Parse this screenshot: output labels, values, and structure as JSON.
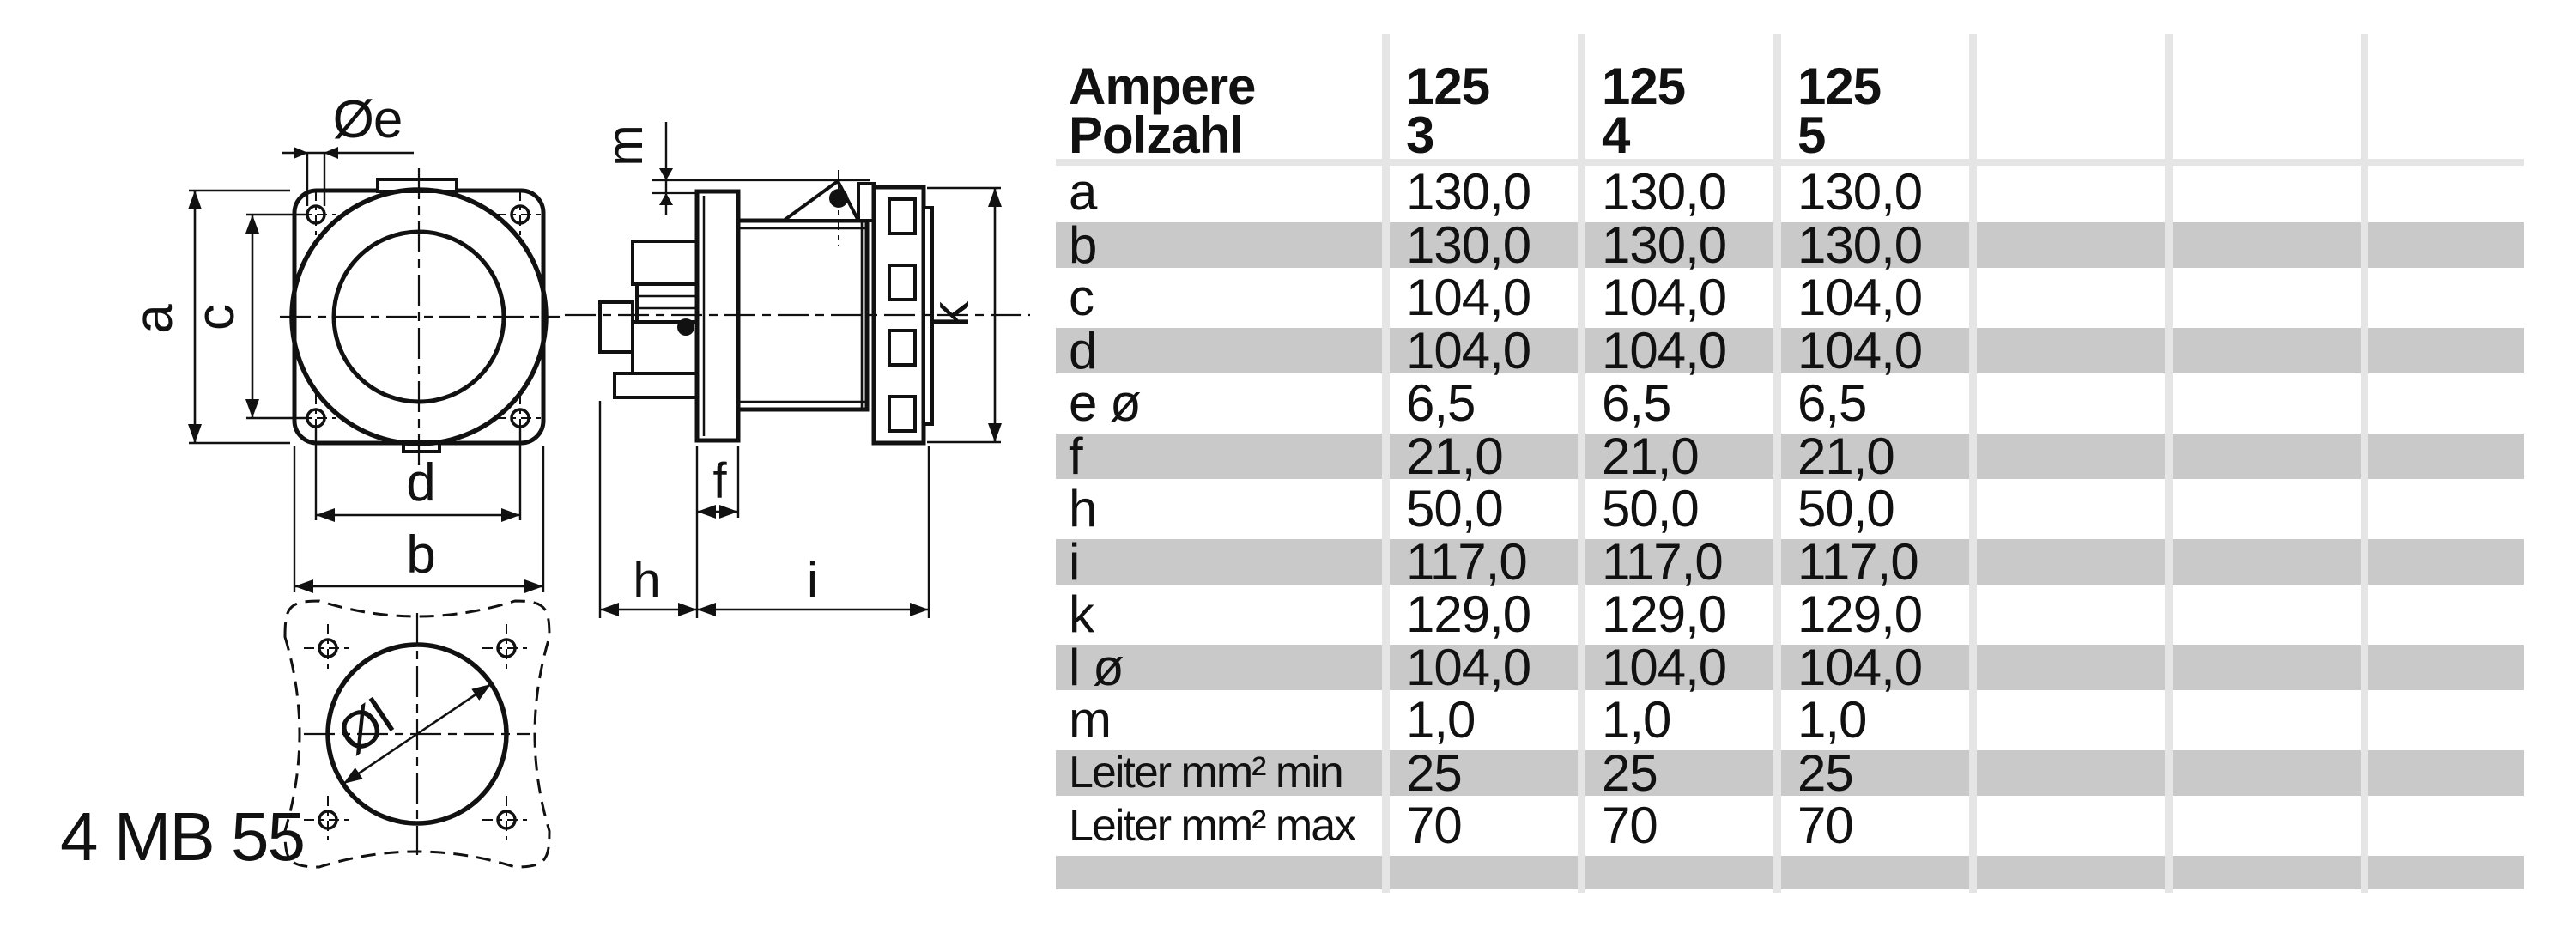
{
  "part_number": "4 MB 55",
  "drawing": {
    "labels": {
      "a": "a",
      "b": "b",
      "c": "c",
      "d": "d",
      "e_dia": "Øe",
      "f": "f",
      "h": "h",
      "i": "i",
      "k": "k",
      "l_dia": "Øl",
      "m": "m"
    }
  },
  "table": {
    "header": {
      "row1_label": "Ampere",
      "row2_label": "Polzahl",
      "columns": [
        {
          "ampere": "125",
          "polzahl": "3"
        },
        {
          "ampere": "125",
          "polzahl": "4"
        },
        {
          "ampere": "125",
          "polzahl": "5"
        },
        {
          "ampere": "",
          "polzahl": ""
        },
        {
          "ampere": "",
          "polzahl": ""
        },
        {
          "ampere": "",
          "polzahl": ""
        }
      ]
    },
    "rows": [
      {
        "label": "a",
        "values": [
          "130,0",
          "130,0",
          "130,0",
          "",
          "",
          ""
        ]
      },
      {
        "label": "b",
        "values": [
          "130,0",
          "130,0",
          "130,0",
          "",
          "",
          ""
        ]
      },
      {
        "label": "c",
        "values": [
          "104,0",
          "104,0",
          "104,0",
          "",
          "",
          ""
        ]
      },
      {
        "label": "d",
        "values": [
          "104,0",
          "104,0",
          "104,0",
          "",
          "",
          ""
        ]
      },
      {
        "label": "e ø",
        "values": [
          "6,5",
          "6,5",
          "6,5",
          "",
          "",
          ""
        ]
      },
      {
        "label": "f",
        "values": [
          "21,0",
          "21,0",
          "21,0",
          "",
          "",
          ""
        ]
      },
      {
        "label": "h",
        "values": [
          "50,0",
          "50,0",
          "50,0",
          "",
          "",
          ""
        ]
      },
      {
        "label": "i",
        "values": [
          "117,0",
          "117,0",
          "117,0",
          "",
          "",
          ""
        ]
      },
      {
        "label": "k",
        "values": [
          "129,0",
          "129,0",
          "129,0",
          "",
          "",
          ""
        ]
      },
      {
        "label": "l ø",
        "values": [
          "104,0",
          "104,0",
          "104,0",
          "",
          "",
          ""
        ]
      },
      {
        "label": "m",
        "values": [
          "1,0",
          "1,0",
          "1,0",
          "",
          "",
          ""
        ]
      },
      {
        "label": "Leiter mm² min",
        "values": [
          "25",
          "25",
          "25",
          "",
          "",
          ""
        ]
      },
      {
        "label": "Leiter mm² max",
        "values": [
          "70",
          "70",
          "70",
          "",
          "",
          ""
        ]
      },
      {
        "label": "",
        "values": [
          "",
          "",
          "",
          "",
          "",
          ""
        ]
      }
    ]
  },
  "colors": {
    "ink": "#111111",
    "row_band": "#c9c9c9",
    "grid_line": "#e5e5e5",
    "background": "#ffffff"
  }
}
